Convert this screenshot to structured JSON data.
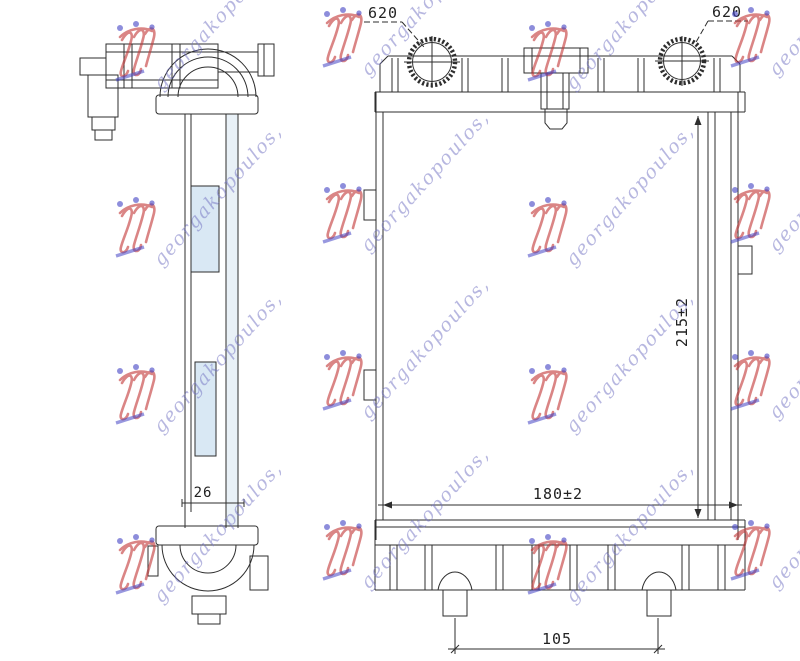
{
  "page": {
    "background": "#ffffff"
  },
  "watermark": {
    "text": "georgakopoulos,",
    "text_color": "#7272c2",
    "logo_red": "#c23535",
    "logo_blue": "#4343c4"
  },
  "drawing": {
    "line_color": "#2e2e2e",
    "panel_fill": "#d9e8f4",
    "channel_fill": "#e9f1f7",
    "labels": {
      "neck_left": "620",
      "neck_right": "620",
      "height": "215±2",
      "width": "180±2",
      "feet_spacing": "105",
      "depth": "26"
    }
  }
}
